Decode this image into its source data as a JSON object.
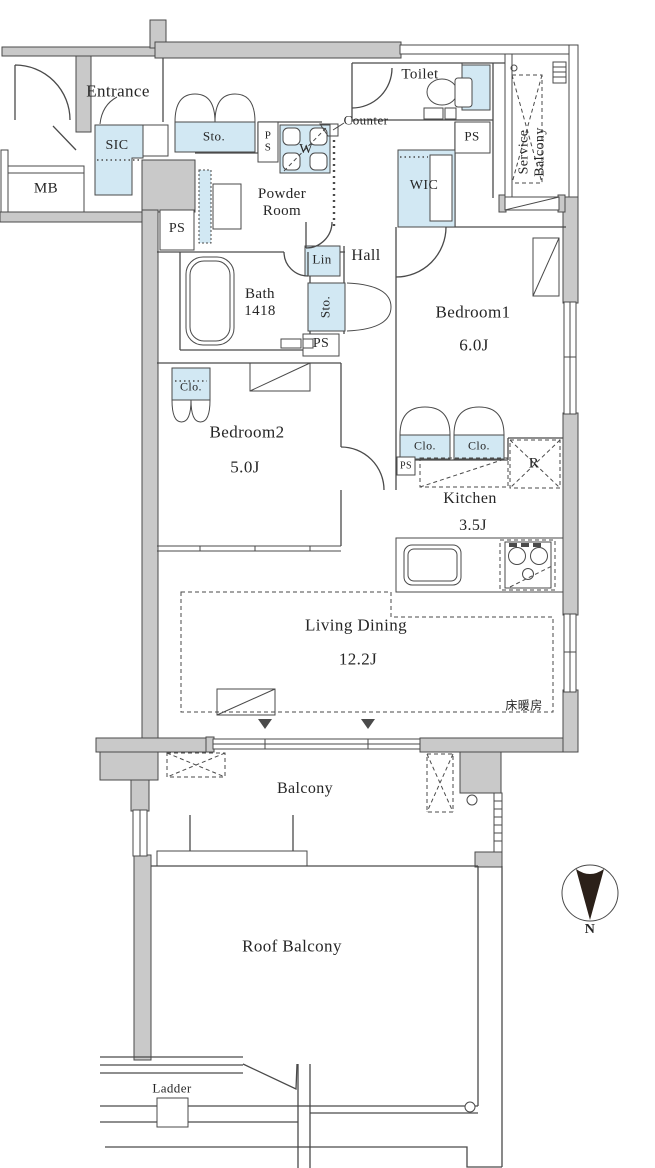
{
  "colors": {
    "wall_fill": "#c9c9c9",
    "fixture_fill": "#d2e8f3",
    "line": "#4a4a4a",
    "text": "#262626",
    "north_fill": "#2b2019"
  },
  "rooms": {
    "entrance": {
      "label": "Entrance"
    },
    "toilet": {
      "label": "Toilet"
    },
    "service_balcony": {
      "label": "Service Balcony"
    },
    "powder_room": {
      "label": "Powder\nRoom"
    },
    "wic": {
      "label": "WIC"
    },
    "hall": {
      "label": "Hall"
    },
    "bath": {
      "label": "Bath\n1418"
    },
    "bedroom1": {
      "label": "Bedroom1",
      "size": "6.0J"
    },
    "bedroom2": {
      "label": "Bedroom2",
      "size": "5.0J"
    },
    "kitchen": {
      "label": "Kitchen",
      "size": "3.5J"
    },
    "living_dining": {
      "label": "Living Dining",
      "size": "12.2J"
    },
    "balcony": {
      "label": "Balcony"
    },
    "roof_balcony": {
      "label": "Roof Balcony"
    }
  },
  "fixtures": {
    "mb": "MB",
    "sic": "SIC",
    "storage": "Sto.",
    "ps": "PS",
    "ps_stacked": "P\nS",
    "washer": "W",
    "counter": "Counter",
    "linen": "Lin",
    "closet": "Clo.",
    "fridge": "R",
    "floor_heating": "床暖房",
    "ladder": "Ladder"
  },
  "compass": {
    "north": "N"
  }
}
